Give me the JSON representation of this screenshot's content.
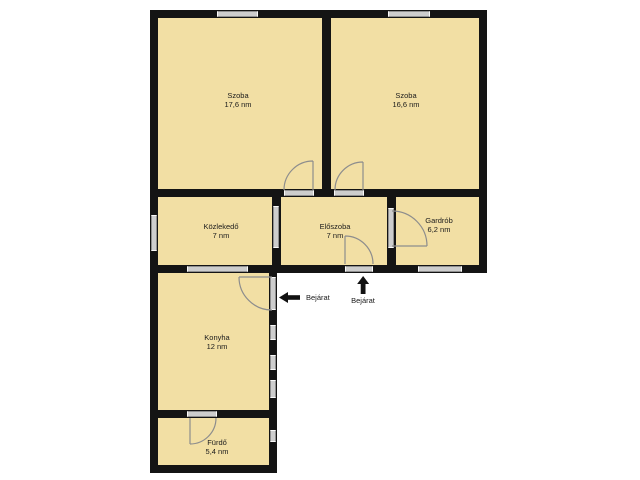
{
  "floorplan": {
    "background_color": "#ffffff",
    "room_fill_color": "#f2dfa4",
    "wall_color": "#141414",
    "opening_color": "#cdcdcd",
    "door_arc_color": "#8d8d8d",
    "rooms": [
      {
        "name": "Szoba",
        "area": "17,6 nm"
      },
      {
        "name": "Szoba",
        "area": "16,6 nm"
      },
      {
        "name": "Közlekedő",
        "area": "7 nm"
      },
      {
        "name": "Előszoba",
        "area": "7 nm"
      },
      {
        "name": "Gardrób",
        "area": "6,2 nm"
      },
      {
        "name": "Konyha",
        "area": "12 nm"
      },
      {
        "name": "Fürdő",
        "area": "5,4 nm"
      }
    ],
    "entrances": [
      {
        "label": "Bejárat",
        "direction": "left"
      },
      {
        "label": "Bejárat",
        "direction": "up"
      }
    ]
  }
}
